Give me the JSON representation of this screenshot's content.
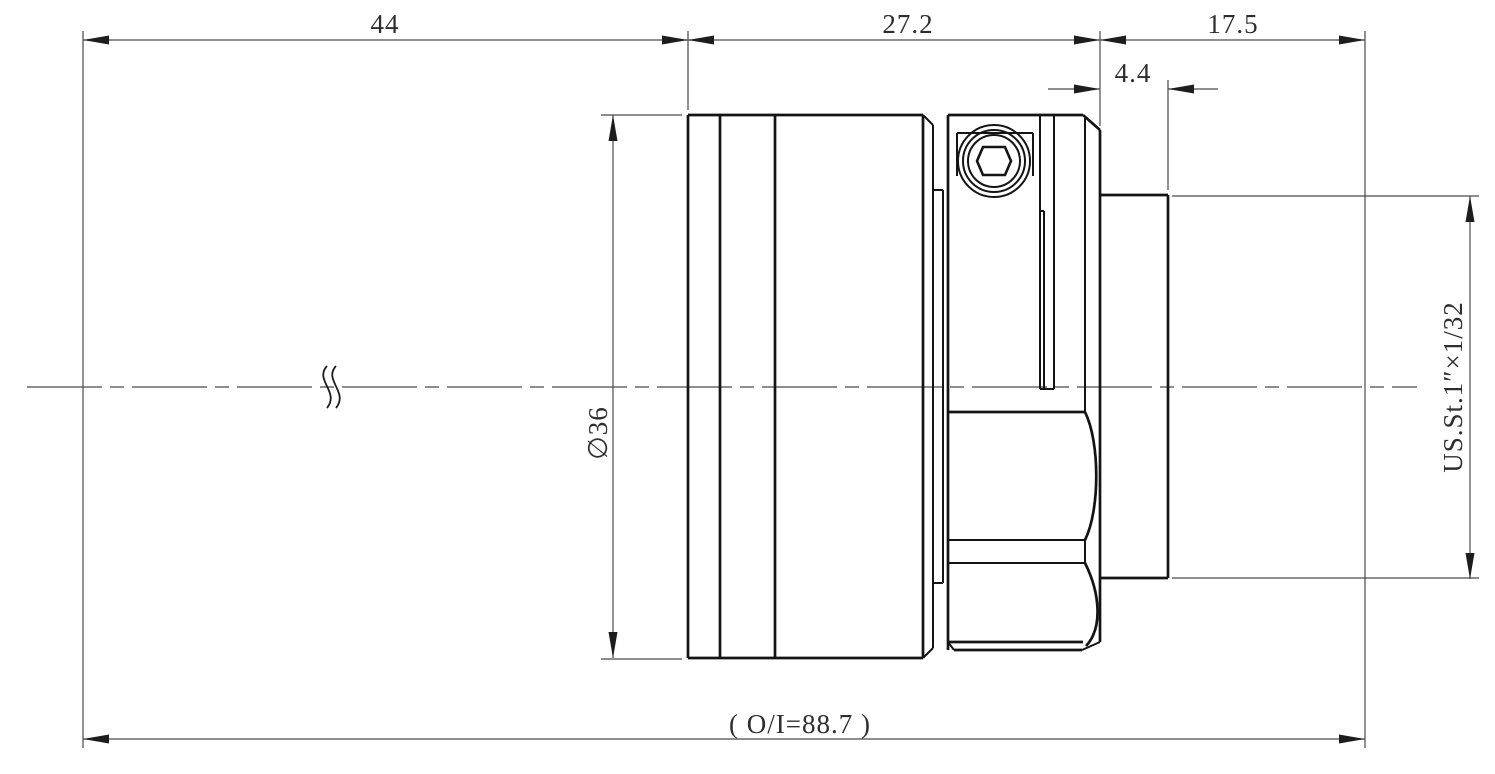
{
  "drawing": {
    "kind": "mechanical engineering dimension drawing",
    "view": "side profile of cylindrical lens barrel with clamp ring, set screw and threaded stub"
  },
  "dimensions": {
    "length_44": "44",
    "length_27_2": "27.2",
    "length_17_5": "17.5",
    "length_4_4": "4.4",
    "diameter_36": "∅36",
    "thread_spec": "US.St.1″×1/32",
    "overall_length": "( O/I=88.7 )"
  },
  "colors": {
    "background": "#ffffff",
    "outline": "#141414",
    "dimension_lines": "#4a4a4a",
    "text": "#2e2e2e"
  }
}
